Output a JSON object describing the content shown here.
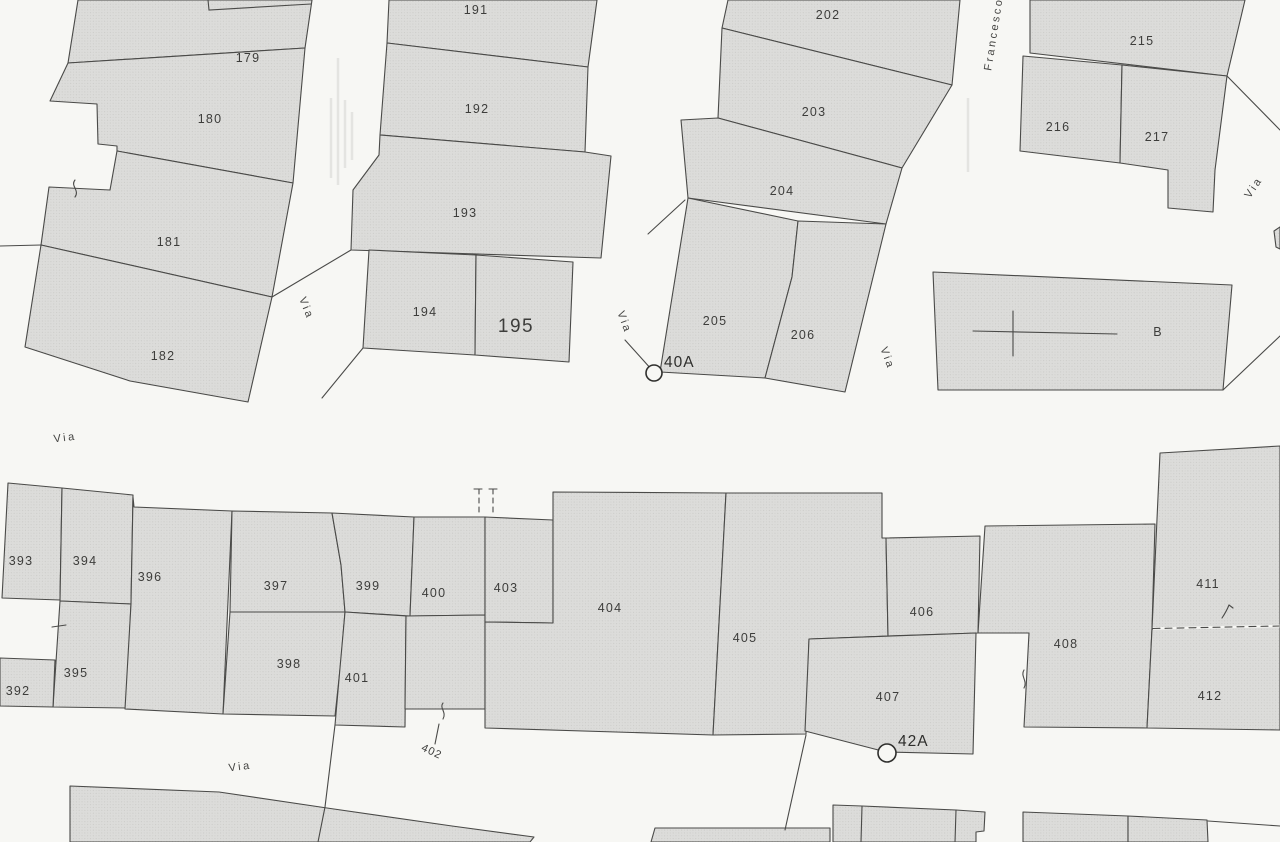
{
  "map": {
    "type": "cadastral-scan",
    "parcels": [
      {
        "id": "179",
        "label": "179"
      },
      {
        "id": "180",
        "label": "180"
      },
      {
        "id": "181",
        "label": "181"
      },
      {
        "id": "182",
        "label": "182"
      },
      {
        "id": "191",
        "label": "191"
      },
      {
        "id": "192",
        "label": "192"
      },
      {
        "id": "193",
        "label": "193"
      },
      {
        "id": "194",
        "label": "194"
      },
      {
        "id": "195",
        "label": "195"
      },
      {
        "id": "202",
        "label": "202"
      },
      {
        "id": "203",
        "label": "203"
      },
      {
        "id": "204",
        "label": "204"
      },
      {
        "id": "205",
        "label": "205"
      },
      {
        "id": "206",
        "label": "206"
      },
      {
        "id": "215",
        "label": "215"
      },
      {
        "id": "216",
        "label": "216"
      },
      {
        "id": "217",
        "label": "217"
      },
      {
        "id": "B",
        "label": "B"
      },
      {
        "id": "392",
        "label": "392"
      },
      {
        "id": "393",
        "label": "393"
      },
      {
        "id": "394",
        "label": "394"
      },
      {
        "id": "395",
        "label": "395"
      },
      {
        "id": "396",
        "label": "396"
      },
      {
        "id": "397",
        "label": "397"
      },
      {
        "id": "398",
        "label": "398"
      },
      {
        "id": "399",
        "label": "399"
      },
      {
        "id": "400",
        "label": "400"
      },
      {
        "id": "401",
        "label": "401"
      },
      {
        "id": "402",
        "label": "402"
      },
      {
        "id": "403",
        "label": "403"
      },
      {
        "id": "404",
        "label": "404"
      },
      {
        "id": "405",
        "label": "405"
      },
      {
        "id": "406",
        "label": "406"
      },
      {
        "id": "407",
        "label": "407"
      },
      {
        "id": "408",
        "label": "408"
      },
      {
        "id": "411",
        "label": "411"
      },
      {
        "id": "412",
        "label": "412"
      }
    ],
    "street_labels": [
      {
        "label": "Via"
      },
      {
        "label": "Via"
      },
      {
        "label": "Via"
      },
      {
        "label": "Francesco"
      },
      {
        "label": "Via"
      },
      {
        "label": "Via"
      },
      {
        "label": "Via"
      }
    ],
    "address_markers": [
      {
        "label": "40A"
      },
      {
        "label": "42A"
      }
    ],
    "colors": {
      "background": "#f7f7f4",
      "parcel_fill": "#dcdcda",
      "parcel_texture": "#c6c6c3",
      "boundary_line": "#4a4a48",
      "text": "#3d3d3b"
    }
  }
}
